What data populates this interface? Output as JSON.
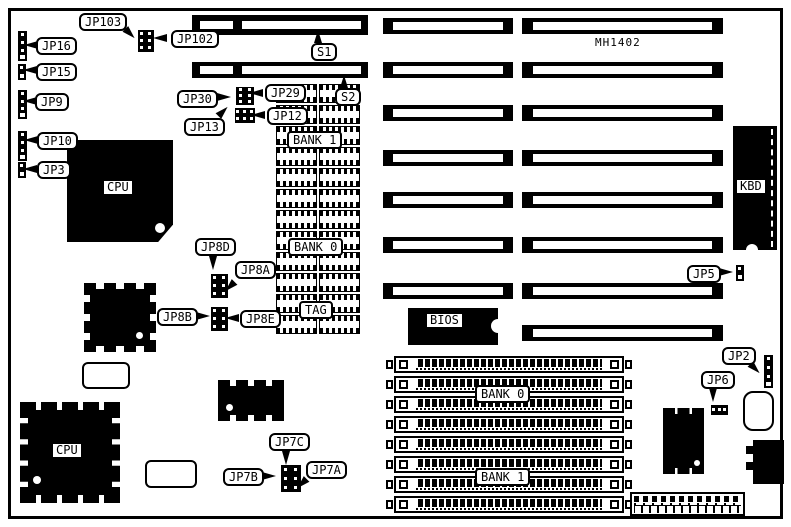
{
  "board": {
    "model_number": "MH1402",
    "background_color": "#ffffff",
    "ink_color": "#000000"
  },
  "labels": {
    "jp103": "JP103",
    "jp102": "JP102",
    "jp16": "JP16",
    "jp15": "JP15",
    "jp9": "JP9",
    "jp10": "JP10",
    "jp3": "JP3",
    "s1": "S1",
    "s2": "S2",
    "jp30": "JP30",
    "jp29": "JP29",
    "jp13": "JP13",
    "jp12": "JP12",
    "bank1_dip": "BANK 1",
    "bank0_dip": "BANK 0",
    "tag": "TAG",
    "cpu_top": "CPU",
    "cpu_bottom": "CPU",
    "bios": "BIOS",
    "kbd": "KBD",
    "jp8d": "JP8D",
    "jp8a": "JP8A",
    "jp8b": "JP8B",
    "jp8e": "JP8E",
    "jp5": "JP5",
    "jp2": "JP2",
    "jp6": "JP6",
    "jp7c": "JP7C",
    "jp7b": "JP7B",
    "jp7a": "JP7A",
    "bank0_simm": "BANK 0",
    "bank1_simm": "BANK 1"
  }
}
